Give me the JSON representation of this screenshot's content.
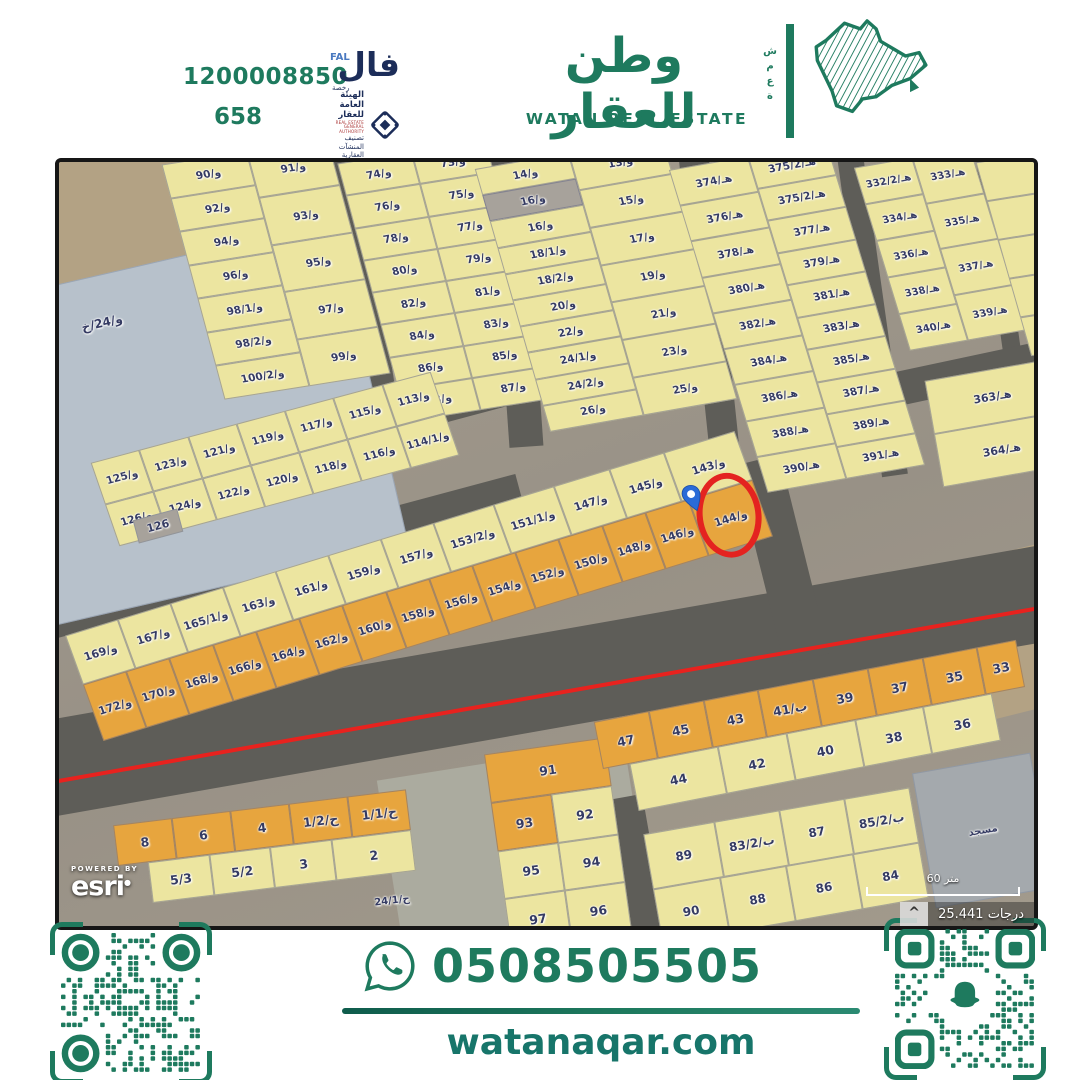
{
  "brand": {
    "green": "#1e7a5e",
    "navy": "#1c2d59",
    "license_label": "1200008850",
    "license_number": "658",
    "fal_ar": "فال",
    "fal_en": "FAL",
    "fal_sub": "رخصة",
    "authority_ar": "الهيئة العامة للعقار",
    "authority_en": "REAL ESTATE GENERAL AUTHORITY",
    "authority_sub": "تصنيف المنشآت العقارية",
    "logo_ar": "وطن للعقار",
    "logo_en": "WATAN REAL ESTATE",
    "logo_side": "ش\nم\nع\nة"
  },
  "footer": {
    "phone": "0508505505",
    "website": "watanaqar.com"
  },
  "map": {
    "attribution_top": "POWERED BY",
    "attribution": "esri",
    "north_glyph": "^",
    "scale_text": "درجات 25.441",
    "scalebar_text": "60 متر",
    "patches": [
      {
        "x": -60,
        "y": -50,
        "w": 280,
        "h": 170,
        "r": -12,
        "f": "S"
      },
      {
        "x": 615,
        "y": 420,
        "w": 440,
        "h": 160,
        "r": -14,
        "f": "S"
      },
      {
        "x": 330,
        "y": 598,
        "w": 250,
        "h": 175,
        "r": -9,
        "f": "S2"
      }
    ],
    "roads": [
      {
        "x": -40,
        "y": 233,
        "w": 740,
        "h": 42,
        "r": -15
      },
      {
        "x": -30,
        "y": 376,
        "w": 500,
        "h": 40,
        "r": -15
      },
      {
        "x": -40,
        "y": 467,
        "w": 1100,
        "h": 96,
        "r": -10
      },
      {
        "x": 700,
        "y": 295,
        "w": 46,
        "h": 205,
        "r": -14
      },
      {
        "x": 292,
        "y": -15,
        "w": 28,
        "h": 280,
        "r": -9
      },
      {
        "x": 440,
        "y": -15,
        "w": 34,
        "h": 300,
        "r": -4
      },
      {
        "x": 636,
        "y": -15,
        "w": 30,
        "h": 330,
        "r": -6
      },
      {
        "x": 800,
        "y": -15,
        "w": 26,
        "h": 330,
        "r": -8
      },
      {
        "x": 930,
        "y": -15,
        "w": 18,
        "h": 210,
        "r": -8
      },
      {
        "x": 1002,
        "y": -20,
        "w": 60,
        "h": 260,
        "r": -6
      },
      {
        "x": 818,
        "y": 193,
        "w": 200,
        "h": 34,
        "r": -12
      },
      {
        "x": 560,
        "y": 634,
        "w": 36,
        "h": 145,
        "r": -10
      },
      {
        "x": -40,
        "y": 527,
        "w": 1100,
        "h": 4,
        "r": -10,
        "f": "RED"
      }
    ],
    "blocks": [
      {
        "id": "vacant",
        "x": -45,
        "y": 95,
        "w": 360,
        "h": 330,
        "r": -13,
        "f": "B"
      },
      {
        "id": "vacant-label",
        "x": -5,
        "y": 150,
        "w": 96,
        "h": 22,
        "r": -13,
        "f": "N",
        "fs": 12,
        "label": "و/24/خ"
      },
      {
        "id": "b90",
        "x": 133,
        "y": -14,
        "w": 168,
        "h": 242,
        "r": -9,
        "k": 6,
        "f": "Y",
        "fs": 10.5,
        "cols": [
          {
            "w": 1.05,
            "cells": [
              "و/90",
              "و/92",
              "و/94",
              "و/96",
              "و/98/1",
              "و/98/2",
              "و/100/2"
            ]
          },
          {
            "w": 1,
            "cells": [
              "و/91",
              "و/93",
              "و/95",
              "و/97",
              "و/99"
            ]
          }
        ]
      },
      {
        "id": "b74",
        "x": 312,
        "y": -14,
        "w": 150,
        "h": 266,
        "r": -9,
        "k": 6,
        "f": "Y",
        "fs": 10.5,
        "cols": [
          {
            "w": 1,
            "cells": [
              "و/74",
              "و/76",
              "و/78",
              "و/80",
              "و/82",
              "و/84",
              "و/86",
              "و/88"
            ]
          },
          {
            "w": 1,
            "cells": [
              "و/73",
              "و/75",
              "و/77",
              "و/79",
              "و/81",
              "و/83",
              "و/85",
              "و/87"
            ]
          }
        ]
      },
      {
        "id": "b13",
        "x": 452,
        "y": -14,
        "w": 190,
        "h": 272,
        "r": -10,
        "k": 6,
        "f": "Y",
        "fs": 10.5,
        "cols": [
          {
            "w": 1,
            "cells": [
              "و/14",
              {
                "t": "و/16",
                "f": "G"
              },
              "و/16",
              "و/18/1",
              "و/18/2",
              "و/20",
              "و/22",
              "و/24/1",
              "و/24/2",
              "و/26"
            ]
          },
          {
            "w": 1,
            "cells": [
              "و/13",
              "و/15",
              "و/17",
              "و/19",
              "و/21",
              "و/23",
              "و/25"
            ]
          }
        ]
      },
      {
        "id": "b374",
        "x": 658,
        "y": -12,
        "w": 160,
        "h": 335,
        "r": -10,
        "k": 7,
        "f": "Y",
        "fs": 10.5,
        "cols": [
          {
            "w": 1,
            "cells": [
              "هـ/374",
              "هـ/376",
              "هـ/378",
              "هـ/380",
              "هـ/382",
              "هـ/384",
              "هـ/386",
              "هـ/388",
              "هـ/390"
            ]
          },
          {
            "w": 1,
            "cells": [
              "هـ/375/2",
              "هـ/375/2",
              "هـ/377",
              "هـ/379",
              "هـ/381",
              "هـ/383",
              "هـ/385",
              "هـ/387",
              "هـ/389",
              "هـ/391"
            ]
          }
        ]
      },
      {
        "id": "b332",
        "x": 822,
        "y": -8,
        "w": 118,
        "h": 190,
        "r": -10,
        "k": 7,
        "f": "Y",
        "fs": 10,
        "cols": [
          {
            "w": 1,
            "cells": [
              "هـ/332/2",
              "هـ/334",
              "هـ/336",
              "هـ/338",
              "هـ/340"
            ]
          },
          {
            "w": 1,
            "cells": [
              "هـ/333",
              "هـ/335",
              "هـ/337",
              "هـ/339"
            ]
          }
        ]
      },
      {
        "id": "bedge",
        "x": 944,
        "y": -8,
        "w": 68,
        "h": 200,
        "r": -9,
        "k": 7,
        "f": "Y",
        "cols": [
          {
            "w": 1,
            "cells": [
              "",
              "",
              "",
              "",
              ""
            ]
          }
        ]
      },
      {
        "id": "b363",
        "x": 874,
        "y": 207,
        "w": 128,
        "h": 108,
        "r": -10,
        "f": "Y",
        "rows": [
          {
            "cells": [
              "هـ/363"
            ]
          },
          {
            "cells": [
              "هـ/364"
            ]
          }
        ]
      },
      {
        "id": "b113",
        "x": 40,
        "y": 253,
        "w": 352,
        "h": 88,
        "r": -15,
        "k": 4,
        "f": "Y",
        "fs": 10.5,
        "rows": [
          {
            "cells": [
              "و/125",
              "و/123",
              "و/121",
              "و/119",
              "و/117",
              "و/115",
              "و/113"
            ]
          },
          {
            "cells": [
              "و/126",
              "و/124",
              "و/122",
              "و/120",
              "و/118",
              "و/116",
              "و/114/1"
            ]
          }
        ]
      },
      {
        "id": "b126-gray",
        "x": 76,
        "y": 352,
        "w": 44,
        "h": 22,
        "r": -15,
        "f": "G",
        "fs": 11,
        "label": "126"
      },
      {
        "id": "subject",
        "x": 10,
        "y": 368,
        "w": 700,
        "h": 112,
        "r": -17,
        "k": 3,
        "f": "Y",
        "fs": 11,
        "rows": [
          {
            "h": 1,
            "cells": [
              "و/169",
              "و/167",
              "و/165/1",
              "و/163",
              "و/161",
              "و/159",
              "و/157",
              {
                "t": "و/153/2",
                "fx": 1.15
              },
              {
                "t": "و/151/1",
                "fx": 1.15
              },
              {
                "t": "و/147",
                "fx": 1.05
              },
              {
                "t": "و/145",
                "fx": 1.05
              },
              {
                "t": "و/143",
                "fx": 1.35
              }
            ]
          },
          {
            "h": 1.15,
            "f": "O",
            "cells": [
              "و/172",
              "و/170",
              "و/168",
              "و/166",
              "و/164",
              "و/162",
              "و/160",
              "و/158",
              "و/156",
              "و/154",
              "و/152",
              "و/150",
              "و/148",
              "و/146",
              {
                "t": "و/144",
                "fx": 1.5,
                "circle": true,
                "pin": true
              }
            ]
          }
        ]
      },
      {
        "id": "b8",
        "x": 58,
        "y": 645,
        "w": 295,
        "h": 82,
        "r": -7,
        "f": "O",
        "fs": 12.5,
        "rtr": 45,
        "rows": [
          {
            "cells": [
              "8",
              "6",
              "4",
              "ح/1/2",
              "ح/1/1"
            ]
          },
          {
            "cells": [
              {
                "t": "",
                "f": "N",
                "fx": 0.5
              },
              {
                "t": "5/3",
                "f": "Y"
              },
              {
                "t": "5/2",
                "f": "Y"
              },
              {
                "t": "3",
                "f": "Y"
              },
              {
                "t": "2",
                "f": "Y",
                "fx": 1.3
              }
            ]
          }
        ]
      },
      {
        "id": "b24-1",
        "x": 298,
        "y": 730,
        "w": 70,
        "h": 18,
        "r": -7,
        "f": "N",
        "fs": 10,
        "label": "ح/24/1"
      },
      {
        "id": "b91",
        "x": 438,
        "y": 583,
        "w": 122,
        "h": 195,
        "r": -8,
        "f": "Y",
        "fs": 12.5,
        "tlr": 60,
        "rows": [
          {
            "f": "O",
            "cells": [
              "91"
            ]
          },
          {
            "cells": [
              {
                "t": "93",
                "f": "O"
              },
              "92"
            ]
          },
          {
            "cells": [
              "95",
              "94"
            ]
          },
          {
            "cells": [
              "97",
              "96"
            ]
          }
        ]
      },
      {
        "id": "b33",
        "x": 540,
        "y": 518,
        "w": 430,
        "h": 96,
        "r": -11,
        "f": "Y",
        "fs": 12.5,
        "rows": [
          {
            "f": "O",
            "cells": [
              "47",
              "45",
              "43",
              "ب/41",
              "39",
              "37",
              "35",
              {
                "t": "33",
                "fx": 0.7
              }
            ]
          },
          {
            "cells": [
              {
                "t": "",
                "f": "N",
                "fx": 0.4
              },
              {
                "t": "44",
                "fx": 1.3
              },
              "42",
              "40",
              "38",
              "36",
              {
                "t": "",
                "f": "N",
                "fx": 0.5
              }
            ]
          }
        ]
      },
      {
        "id": "b83",
        "x": 592,
        "y": 648,
        "w": 270,
        "h": 112,
        "r": -10,
        "f": "Y",
        "fs": 12,
        "rows": [
          {
            "cells": [
              {
                "t": "89",
                "fx": 1.1
              },
              "ب/83/2",
              "87",
              "ب/85/2"
            ]
          },
          {
            "cells": [
              "90",
              "88",
              "86",
              "84"
            ]
          }
        ]
      },
      {
        "id": "mosque",
        "x": 864,
        "y": 600,
        "w": 118,
        "h": 135,
        "r": -10,
        "f": "M",
        "fs": 10,
        "label": "مسجد"
      }
    ]
  }
}
